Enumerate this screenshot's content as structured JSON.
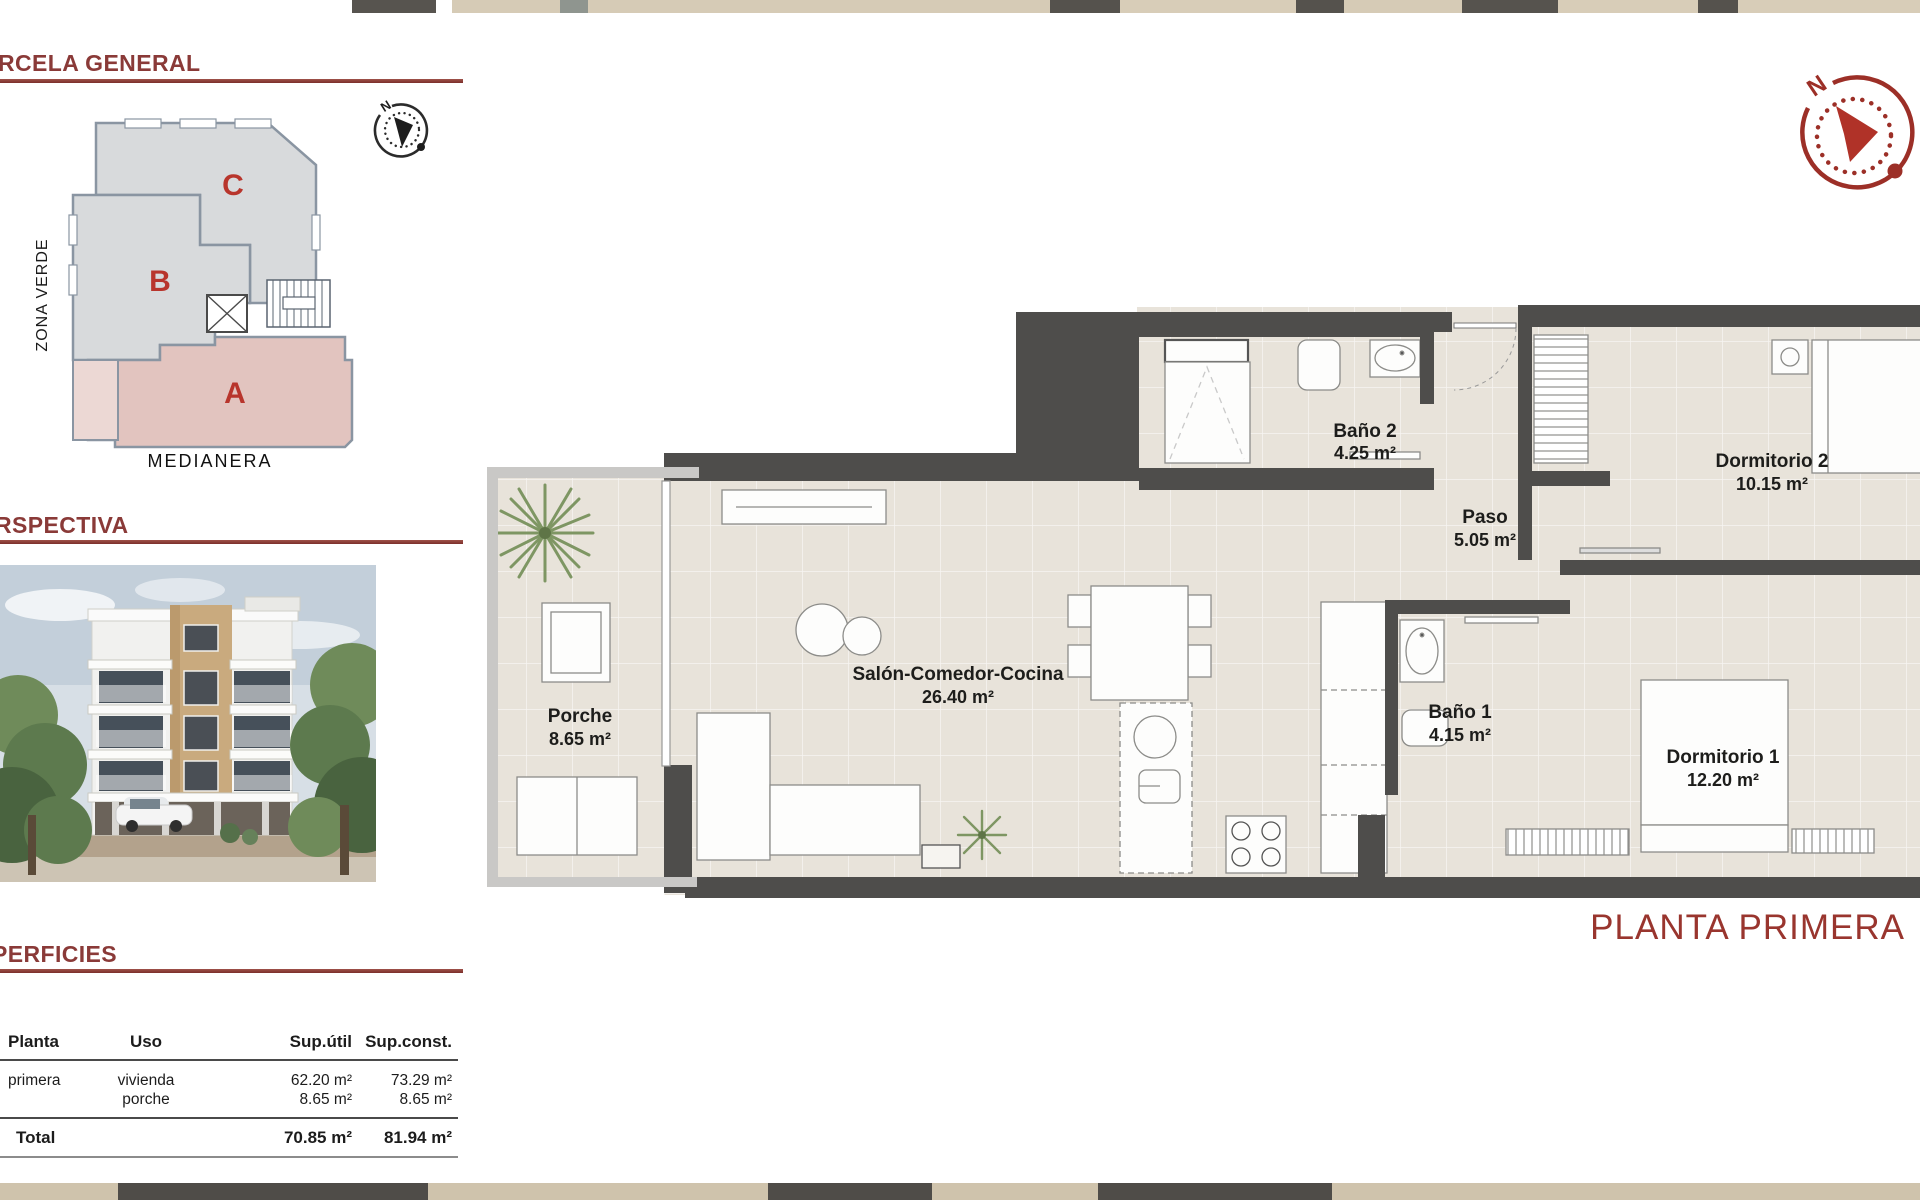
{
  "header": {
    "planta_title": "PLANTA PRIMERA"
  },
  "sections": {
    "parcela": {
      "title": "RCELA GENERAL"
    },
    "perspectiva": {
      "title": "RSPECTIVA"
    },
    "superficies": {
      "title": "PERFICIES"
    }
  },
  "site_plan": {
    "zona_verde": "ZONA VERDE",
    "medianera": "MEDIANERA",
    "block_a": "A",
    "block_b": "B",
    "block_c": "C",
    "north": "N"
  },
  "floorplan": {
    "north": "N",
    "rooms": [
      {
        "name": "Porche",
        "area": "8.65 m²"
      },
      {
        "name": "Salón-Comedor-Cocina",
        "area": "26.40 m²"
      },
      {
        "name": "Baño 2",
        "area": "4.25 m²"
      },
      {
        "name": "Paso",
        "area": "5.05 m²"
      },
      {
        "name": "Dormitorio 2",
        "area": "10.15 m²"
      },
      {
        "name": "Baño 1",
        "area": "4.15 m²"
      },
      {
        "name": "Dormitorio 1",
        "area": "12.20 m²"
      }
    ]
  },
  "table": {
    "headers": {
      "planta": "Planta",
      "uso": "Uso",
      "util": "Sup.útil",
      "const": "Sup.const."
    },
    "rows": [
      {
        "planta": "primera",
        "uso": "vivienda",
        "util": "62.20 m²",
        "const": "73.29 m²"
      },
      {
        "planta": "",
        "uso": "porche",
        "util": "8.65 m²",
        "const": "8.65 m²"
      }
    ],
    "total": {
      "label": "Total",
      "util": "70.85 m²",
      "const": "81.94 m²"
    }
  },
  "colors": {
    "accent": "#8a3a38",
    "title": "#99352e",
    "wall": "#4e4d4b",
    "floor": "#e8e3da",
    "block_pink": "#e2c4bf",
    "block_gray": "#d8dadc"
  }
}
